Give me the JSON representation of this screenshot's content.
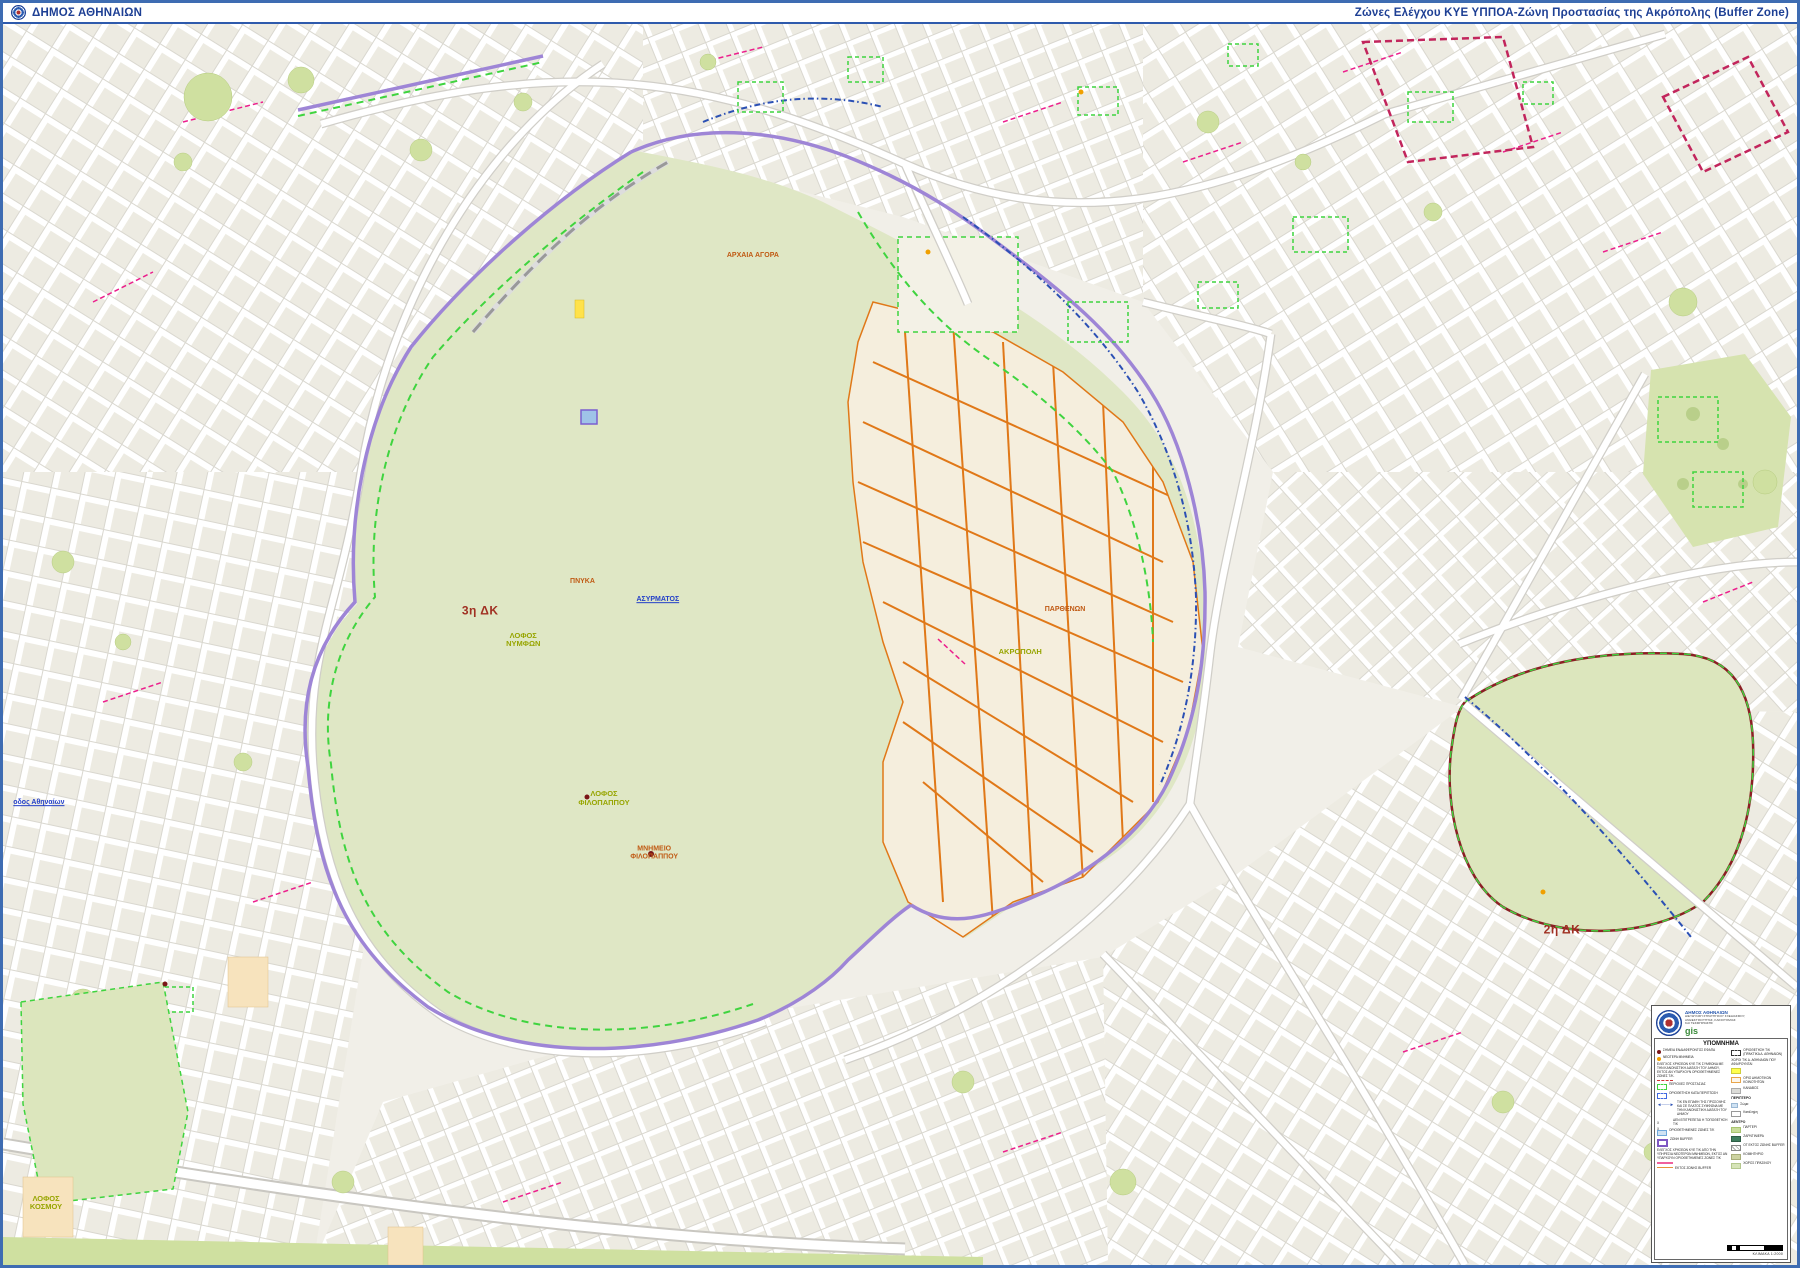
{
  "header": {
    "municipality": "ΔΗΜΟΣ ΑΘΗΝΑΙΩΝ",
    "title": "Ζώνες Ελέγχου ΚΥΕ ΥΠΠΟΑ-Ζώνη Προστασίας της Ακρόπολης (Buffer Zone)"
  },
  "map": {
    "labels": [
      {
        "text": "ΠΑΡΘΕΝΩΝ",
        "x": 59.2,
        "y": 47.2,
        "color": "orange"
      },
      {
        "text": "ΑΚΡΟΠΟΛΗ",
        "x": 56.7,
        "y": 50.6,
        "color": "green"
      },
      {
        "text": "3η ΔΚ",
        "x": 26.6,
        "y": 47.3,
        "color": "red"
      },
      {
        "text": "2η ΔΚ",
        "x": 86.9,
        "y": 73.0,
        "color": "red"
      },
      {
        "text": "ΠΝΥΚΑ",
        "x": 32.3,
        "y": 45.0,
        "color": "orange"
      },
      {
        "text": "ΛΟΦΟΣ\nΝΥΜΦΩΝ",
        "x": 29.0,
        "y": 49.6,
        "color": "green"
      },
      {
        "text": "ΛΟΦΟΣ\nΦΙΛΟΠΑΠΠΟΥ",
        "x": 33.5,
        "y": 62.4,
        "color": "green"
      },
      {
        "text": "ΜΝΗΜΕΙΟ\nΦΙΛΟΠΑΠΠΟΥ",
        "x": 36.3,
        "y": 66.8,
        "color": "orange"
      },
      {
        "text": "ΑΡΧΑΙΑ ΑΓΟΡΑ",
        "x": 41.8,
        "y": 18.7,
        "color": "orange"
      },
      {
        "text": "ΑΣΥΡΜΑΤΟΣ",
        "x": 36.5,
        "y": 46.4,
        "color": "blue"
      },
      {
        "text": "ΛΟΦΟΣ\nΚΟΣΜΟΥ",
        "x": 2.4,
        "y": 95.0,
        "color": "green"
      },
      {
        "text": "οδος Αθηναίων",
        "x": 2.0,
        "y": 62.8,
        "color": "blue"
      }
    ]
  },
  "legend": {
    "org": {
      "name": "ΔΗΜΟΣ ΑΘΗΝΑΙΩΝ",
      "dept_line1": "ΔΙΕΥΘΥΝΣΗ ΣΤΡΑΤΗΓΙΚΟΥ ΣΧΕΔΙΑΣΜΟΥ,",
      "dept_line2": "ΑΝΘΕΚΤΙΚΟΤΗΤΑΣ, ΚΑΙΝΟΤΟΜΙΑΣ",
      "dept_line3": "ΚΑΙ ΤΕΚΜΗΡΙΩΣΗΣ",
      "gis": "gis"
    },
    "title": "ΥΠΟΜΝΗΜΑ",
    "left_entries": [
      {
        "swatch": "dot-darkred",
        "label": "ΣΗΜΕΙΑ ΕΝΔΙΑΦΕΡΟΝΤΟΣ ΕΦΑΠΑ"
      },
      {
        "swatch": "dot-orange",
        "label": "ΝΕΩΤΕΡΑ ΜΝΗΜΕΙΑ"
      },
      {
        "swatch": "dashes-red-below",
        "label": "ΕΛΕΓΧΟΣ ΧΡΗΣΕΩΝ ΚΥΕ Τ/Κ ΣΥΜΦΩΝΑ ΜΕ ΤΗΝ ΚΑΝΟΝΙΣΤΙΚΗ ΔΙΑΤΑΞΗ ΤΟΥ ΔΗΜΟΥ, ΕΚΤΟΣ ΑΝ ΥΠΑΡΧΟΥΝ ΟΡΙΟΘΕΤΗΜΕΝΕΣ ΖΩΝΕΣ Τ/Κ."
      },
      {
        "swatch": "box-dashed-green",
        "label": "ΠΕΡΙΟΧΕΣ ΠΡΟΣΤΑΣΙΑΣ"
      },
      {
        "swatch": "box-dashed-blue",
        "label": "ΟΡΙΟΘΕΤΗΣΗ ΚΑΤΑ ΠΕΡΙΠΤΩΣΗ"
      },
      {
        "swatch": "arrow-blue",
        "label": "Τ/Κ ΕΝ ΕΠΑΦΗ ΤΗΣ ΠΡΟΣΟΨΗΣ ΚΑΙ ΣΕ ΠΛΑΤΟΣ ΣΥΜΦΩΝΑ ΜΕ ΤΗΝ ΚΑΝΟΝΙΣΤΙΚΗ ΔΙΑΤΑΞΗ ΤΟΥ ΔΗΜΟΥ"
      },
      {
        "swatch": "xx",
        "label": "ΔΕΝ ΕΠΙΤΡΕΠΕΤΑΙ Η ΤΟΠΟΘΕΤΗΣΗ Τ/Κ"
      },
      {
        "swatch": "box-lightblue",
        "label": "ΟΡΙΟΘΕΤΗΜΕΝΕΣ ΖΩΝΕΣ Τ/Κ"
      },
      {
        "swatch": "box-purple",
        "label": "ΖΩΝΗ BUFFER"
      },
      {
        "swatch": "line-pink-below",
        "label": "ΕΛΕΓΧΟΣ ΧΡΗΣΕΩΝ ΚΥΕ Τ/Κ ΑΠΟ ΤΗΝ ΥΠΗΡΕΣΙΑ ΝΕΩΤΕΡΩΝ ΜΝΗΜΕΙΩΝ, ΕΚΤΟΣ ΑΝ ΥΠΑΡΧΟΥΝ ΟΡΙΟΘΕΤΗΜΕΝΕΣ ΖΩΝΕΣ Τ/Κ"
      },
      {
        "swatch": "line-orange",
        "label": "ΕΚΤΟΣ ΖΩΝΗΣ BUFFER"
      }
    ],
    "right_entries": [
      {
        "swatch": "box-dashed-black",
        "label": "ΟΡΙΟΘΕΤΗΣΗ Τ/Κ (ΠΡΑΚΤΙΚΑ Δ. ΑΘΗΝΑΙΩΝ)"
      },
      {
        "swatch": "box-yellow-below",
        "label": "ΧΩΡΟΙ Τ/Κ Δ. ΑΘΗΝΑΙΩΝ ΠΟΥ ΑΦΑΙΡΟΥΝΤΑΙ"
      },
      {
        "swatch": "box-orange-border",
        "label": "ΟΡΙΟ ΔΗΜΟΤΙΚΩΝ ΚΟΙΝΟΤΗΤΩΝ"
      },
      {
        "swatch": "box-gray",
        "label": "ΚΑΝΑΒΟΣ"
      },
      {
        "swatch": "header",
        "label": "ΠΕΡΙΠΤΕΡΟ"
      },
      {
        "swatch": "box-lightblue-small",
        "label": "Σώμα"
      },
      {
        "swatch": "box-white",
        "label": "Κατάληψη"
      },
      {
        "swatch": "header",
        "label": "ΔΕΝΤΡΟ"
      },
      {
        "swatch": "box-lightgreen",
        "label": "ΠΑΡΤΕΡΙ"
      },
      {
        "swatch": "box-darkgreen",
        "label": "ΖΑΡΝΤΙΝΙΕΡΑ"
      },
      {
        "swatch": "box-hatched",
        "label": "ΟΤ ΕΚΤΟΣ ΖΩΝΗΣ BUFFER"
      },
      {
        "swatch": "box-olive",
        "label": "ΚΟΙΜΗΤΗΡΙΟ"
      },
      {
        "swatch": "box-palegreen",
        "label": "ΧΩΡΟΣ ΠΡΑΣΙΝΟΥ"
      }
    ],
    "scale_label": "ΚΛΙΜΑΚΑ",
    "scale_value": "1:2000"
  },
  "colors": {
    "header_blue": "#1d3f94",
    "frame_blue": "#3e6cb2",
    "buffer_purple": "#9e85d6",
    "protection_green": "#3fd43f",
    "orange_zone": "#e07818",
    "magenta_line": "#ec1e8c",
    "park_green": "#dfe7c5",
    "gis_green": "#3a8a3a"
  }
}
